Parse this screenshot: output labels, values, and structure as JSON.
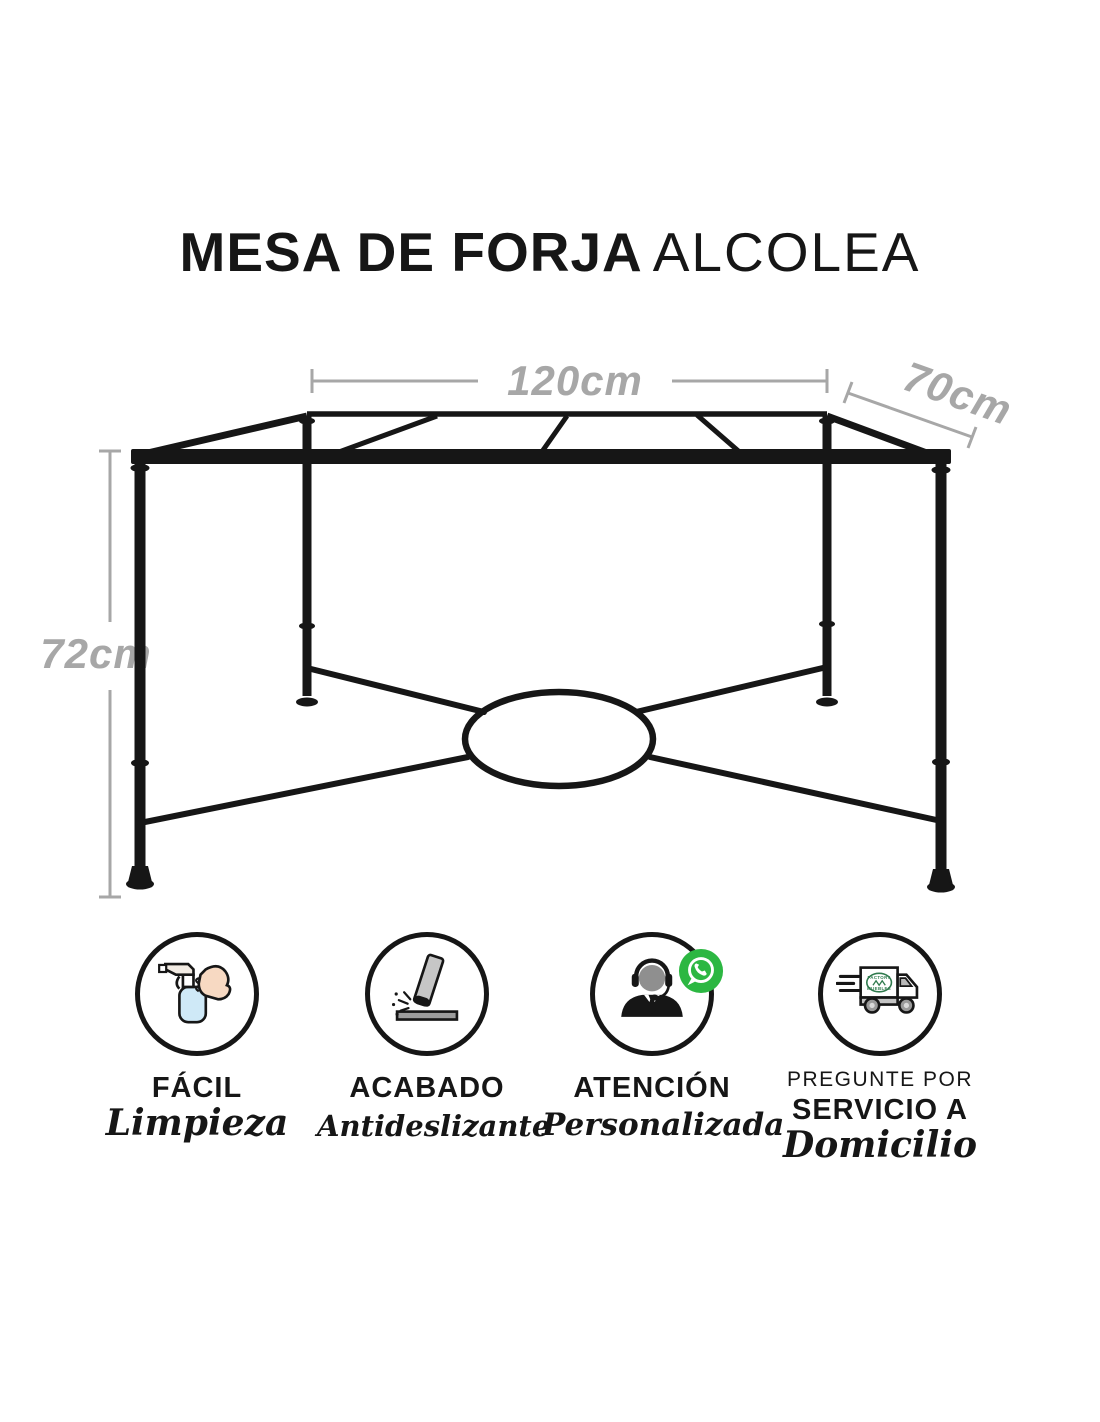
{
  "title": {
    "main": "MESA DE FORJA",
    "secondary": "ALCOLEA"
  },
  "dimensions": {
    "width": "120cm",
    "depth": "70cm",
    "height": "72cm"
  },
  "features": [
    {
      "icon": "spray-bottle-hand-icon",
      "title": "FÁCIL",
      "subtitle": "Limpieza"
    },
    {
      "icon": "anti-slip-impact-icon",
      "title": "ACABADO",
      "subtitle": "Antideslizante"
    },
    {
      "icon": "headset-agent-icon",
      "badge_icon": "whatsapp-icon",
      "title": "ATENCIÓN",
      "subtitle": "Personalizada"
    },
    {
      "icon": "delivery-truck-icon",
      "pre_title": "PREGUNTE POR",
      "title": "SERVICIO A",
      "subtitle": "Domicilio",
      "logo_top": "FACTORY",
      "logo_bottom": "MUEBLES"
    }
  ],
  "colors": {
    "ink_black": "#161616",
    "dimension_gray": "#a7a7a7",
    "whatsapp_green": "#2cb742",
    "truck_logo_green": "#2f7a4d",
    "bottle_blue": "#cfe9f7",
    "hand_peach": "#f7d9c2",
    "metal_gray": "#c6c6c6"
  }
}
